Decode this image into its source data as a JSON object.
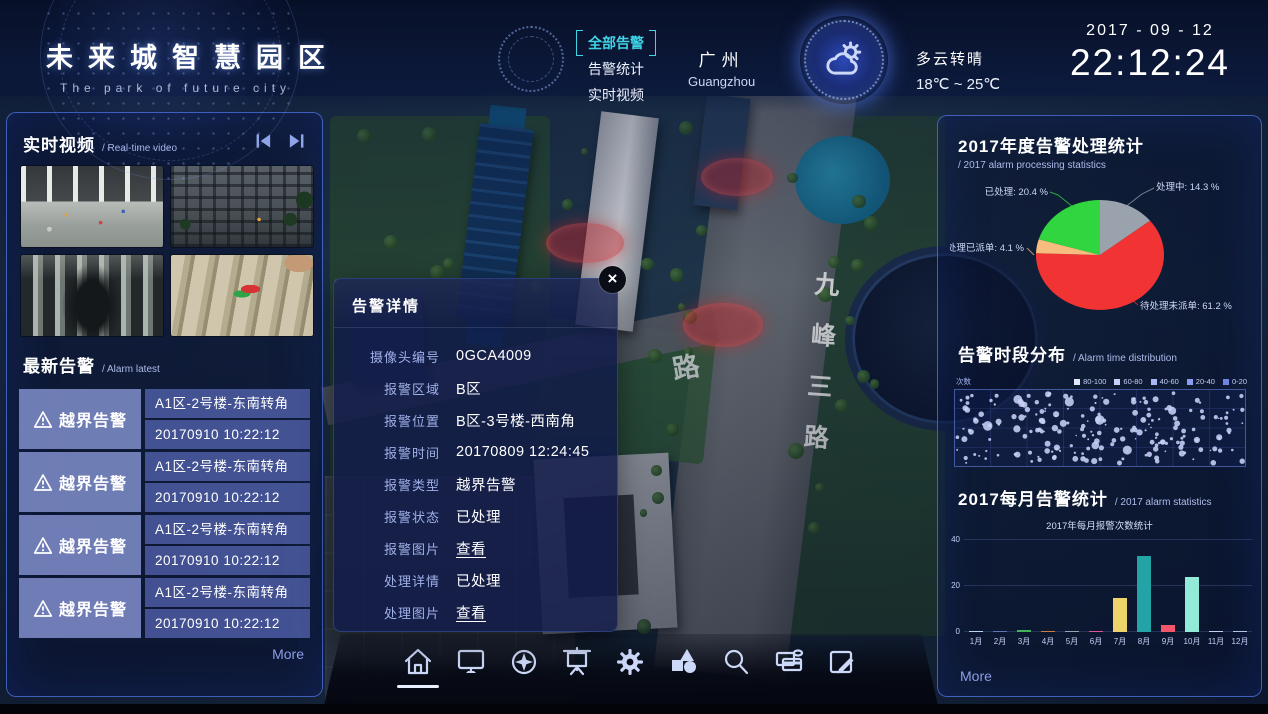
{
  "header": {
    "title": "未来城智慧园区",
    "subtitle": "The park of future city",
    "nav": [
      {
        "label": "全部告警",
        "active": true
      },
      {
        "label": "告警统计"
      },
      {
        "label": "实时视频"
      }
    ],
    "city": {
      "name": "广州",
      "en": "Guangzhou"
    },
    "weather": {
      "desc": "多云转晴",
      "temp": "18℃ ~ 25℃",
      "icon": "cloud-sun-icon"
    },
    "date": "2017 - 09 - 12",
    "time": "22:12:24"
  },
  "left_panel": {
    "video_title": "实时视频",
    "video_subtitle": "/ Real-time video",
    "video_count": 4,
    "alarm_title": "最新告警",
    "alarm_subtitle": "/ Alarm latest",
    "alarms": [
      {
        "type": "越界告警",
        "location": "A1区-2号楼-东南转角",
        "time": "20170910 10:22:12"
      },
      {
        "type": "越界告警",
        "location": "A1区-2号楼-东南转角",
        "time": "20170910 10:22:12"
      },
      {
        "type": "越界告警",
        "location": "A1区-2号楼-东南转角",
        "time": "20170910 10:22:12"
      },
      {
        "type": "越界告警",
        "location": "A1区-2号楼-东南转角",
        "time": "20170910 10:22:12"
      }
    ],
    "more_label": "More"
  },
  "popup": {
    "title": "告警详情",
    "close_icon": "close-icon",
    "fields": [
      {
        "label": "摄像头编号",
        "value": "0GCA4009"
      },
      {
        "label": "报警区域",
        "value": "B区"
      },
      {
        "label": "报警位置",
        "value": "B区-3号楼-西南角"
      },
      {
        "label": "报警时间",
        "value": "20170809 12:24:45"
      },
      {
        "label": "报警类型",
        "value": "越界告警"
      },
      {
        "label": "报警状态",
        "value": "已处理"
      },
      {
        "label": "报警图片",
        "value": "查看",
        "link": true
      },
      {
        "label": "处理详情",
        "value": "已处理"
      },
      {
        "label": "处理图片",
        "value": "查看",
        "link": true
      }
    ]
  },
  "right_panel": {
    "more_label": "More"
  },
  "map": {
    "road_label": "九峰三路",
    "road_label_2": "路",
    "alarm_zones": 3
  },
  "chart_data": [
    {
      "type": "pie",
      "title": "2017年度告警处理统计",
      "subtitle": "/ 2017 alarm processing statistics",
      "unit": "%",
      "start": "top",
      "direction": "clockwise",
      "slices": [
        {
          "label": "处理中",
          "value": 14.3,
          "color": "#9aa3ad"
        },
        {
          "label": "待处理未派单",
          "value": 61.2,
          "color": "#f23333"
        },
        {
          "label": "待处理已派单",
          "value": 4.1,
          "color": "#f6bd7e"
        },
        {
          "label": "已处理",
          "value": 20.4,
          "color": "#31d53f"
        }
      ]
    },
    {
      "type": "scatter",
      "title": "告警时段分布",
      "subtitle": "/ Alarm time distribution",
      "axis_label": "次数",
      "legend": [
        {
          "label": "80-100",
          "color": "#e3e9fc"
        },
        {
          "label": "60-80",
          "color": "#c7d1f8"
        },
        {
          "label": "40-60",
          "color": "#a9b8f4"
        },
        {
          "label": "20-40",
          "color": "#8b9def"
        },
        {
          "label": "0-20",
          "color": "#6f84e8"
        }
      ],
      "point_count": 210,
      "seed": 12,
      "dot_color": "#c7d1f8",
      "values_labeled": false,
      "grid": true
    },
    {
      "type": "bar",
      "title": "2017每月告警统计",
      "subtitle": "/ 2017 alarm statistics",
      "inner_title": "2017年每月报警次数统计",
      "categories": [
        "1月",
        "2月",
        "3月",
        "4月",
        "5月",
        "6月",
        "7月",
        "8月",
        "9月",
        "10月",
        "11月",
        "12月"
      ],
      "values": [
        0.6,
        0.4,
        0.7,
        0.6,
        0.5,
        0.5,
        15,
        33,
        3,
        24,
        0.6,
        0.5
      ],
      "colors": [
        "#b9d8ee",
        "#5f74b4",
        "#43b45c",
        "#d07c42",
        "#98a2b4",
        "#dd5597",
        "#ecd46b",
        "#24a3a6",
        "#f4566a",
        "#94ead9",
        "#c3d2ea",
        "#b6c6e0"
      ],
      "ylim": [
        0,
        40
      ],
      "yticks": [
        0,
        20,
        40
      ],
      "grid": true,
      "legend_position": "none"
    }
  ],
  "toolbar": {
    "active": "home",
    "items": [
      {
        "name": "home-icon"
      },
      {
        "name": "monitor-icon"
      },
      {
        "name": "compass-icon"
      },
      {
        "name": "projector-screen-icon"
      },
      {
        "name": "gear-icon"
      },
      {
        "name": "shapes-icon"
      },
      {
        "name": "search-icon"
      },
      {
        "name": "cards-icon"
      },
      {
        "name": "edit-icon"
      }
    ]
  }
}
